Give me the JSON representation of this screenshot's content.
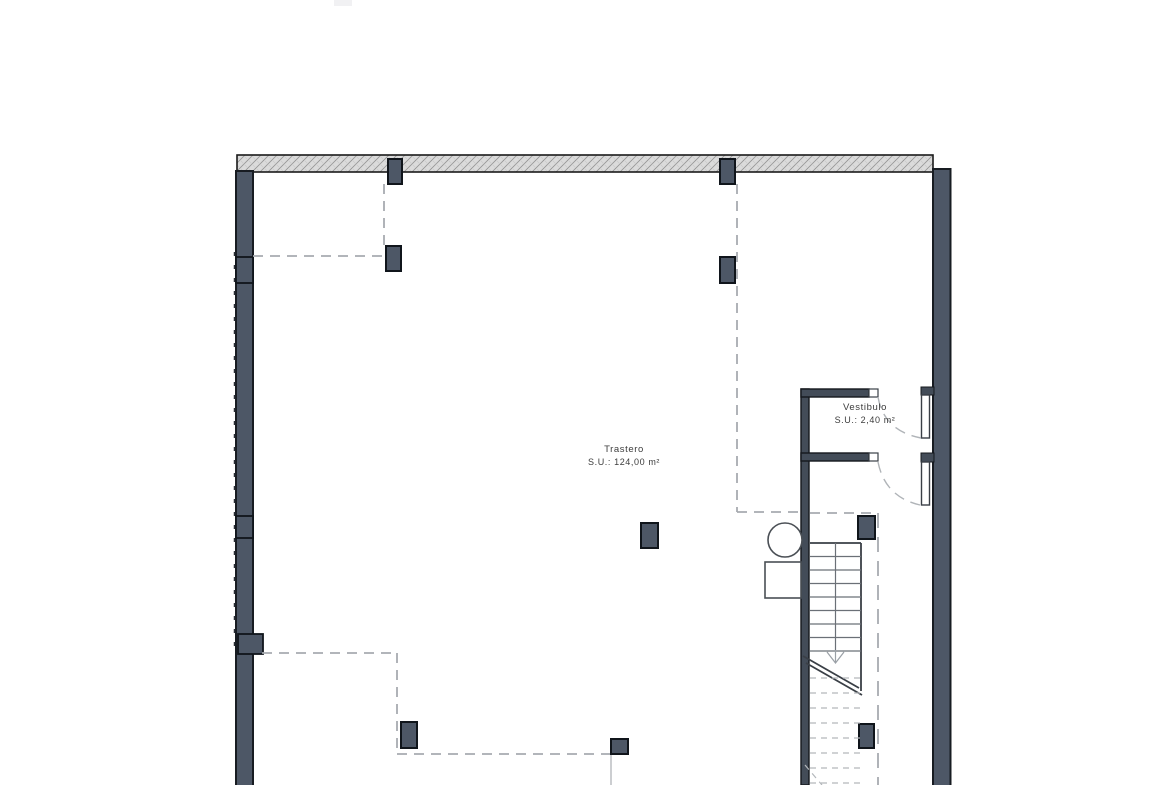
{
  "plan": {
    "rooms": [
      {
        "name": "Trastero",
        "area_label": "S.U.: 124,00 m²"
      },
      {
        "name": "Vestibulo",
        "area_label": "S.U.: 2,40 m²"
      }
    ]
  },
  "colors": {
    "wall_fill": "#4d5766",
    "wall_outline": "#181c22",
    "partition_fill": "#434c58",
    "hatch_fill": "#dbdbdb",
    "hatch_line": "#979797",
    "dash_line": "#a7abb0",
    "stair_line": "#6b7077",
    "stair_edge": "#3a3f46",
    "fixture_line": "#4a4f55",
    "text_color": "#3c3c3c"
  }
}
